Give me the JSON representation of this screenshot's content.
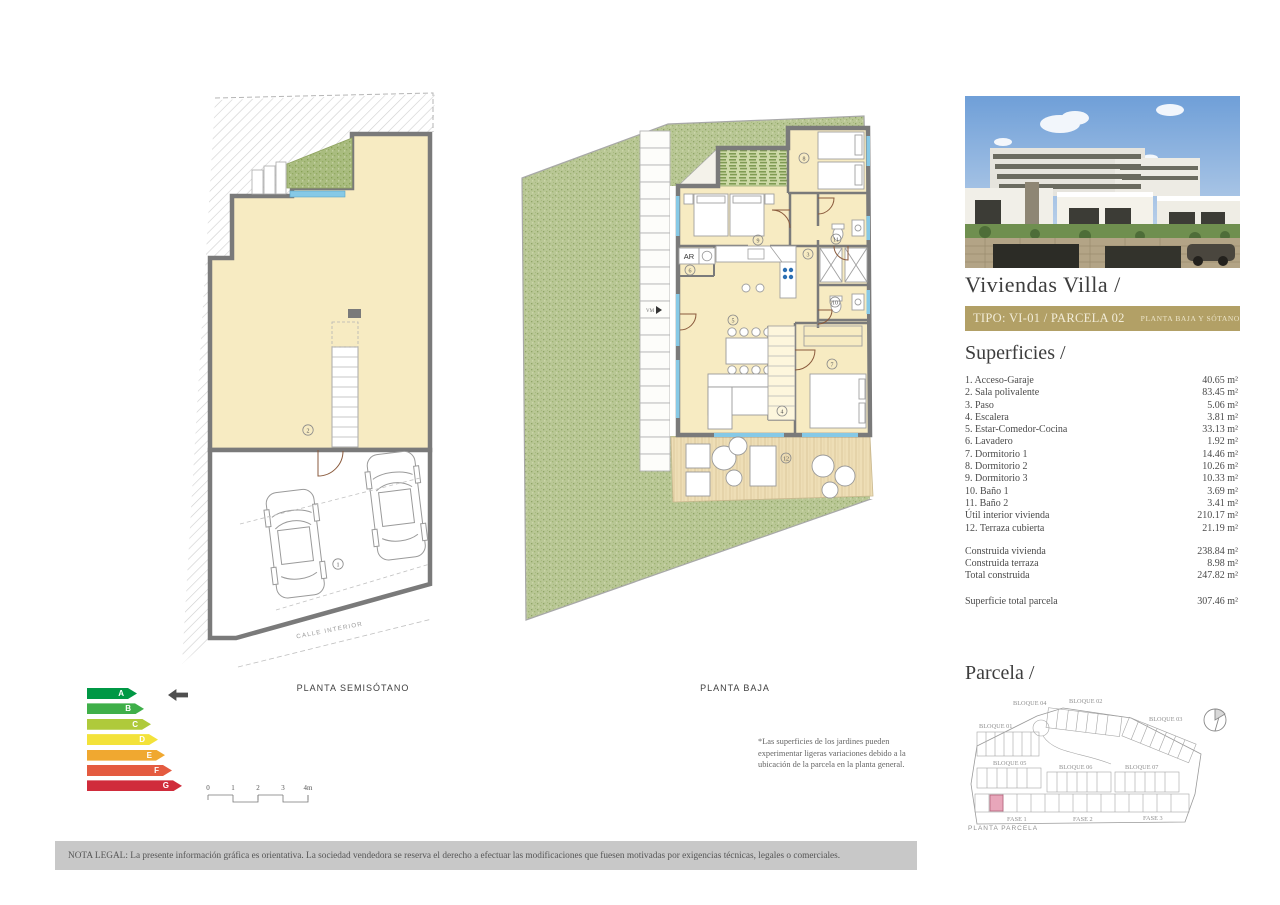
{
  "header": {
    "title": "Viviendas Villa /",
    "banner_left": "TIPO: VI-01 / PARCELA 02",
    "banner_right": "PLANTA BAJA Y SÓTANO",
    "banner_bg": "#b2a066"
  },
  "superficies": {
    "heading": "Superficies /",
    "rows": [
      {
        "label": "1. Acceso-Garaje",
        "value": "40.65 m²"
      },
      {
        "label": "2. Sala polivalente",
        "value": "83.45 m²"
      },
      {
        "label": "3. Paso",
        "value": "5.06 m²"
      },
      {
        "label": "4. Escalera",
        "value": "3.81 m²"
      },
      {
        "label": "5. Estar-Comedor-Cocina",
        "value": "33.13 m²"
      },
      {
        "label": "6. Lavadero",
        "value": "1.92 m²"
      },
      {
        "label": "7. Dormitorio 1",
        "value": "14.46 m²"
      },
      {
        "label": "8. Dormitorio 2",
        "value": "10.26 m²"
      },
      {
        "label": "9. Dormitorio 3",
        "value": "10.33 m²"
      },
      {
        "label": "10. Baño 1",
        "value": "3.69 m²"
      },
      {
        "label": "11. Baño 2",
        "value": "3.41 m²"
      },
      {
        "label": "Útil interior vivienda",
        "value": "210.17 m²"
      },
      {
        "label": "12. Terraza cubierta",
        "value": "21.19 m²"
      }
    ],
    "totals": [
      {
        "label": "Construida vivienda",
        "value": "238.84 m²"
      },
      {
        "label": "Construida terraza",
        "value": "8.98 m²"
      },
      {
        "label": "Total construida",
        "value": "247.82 m²"
      }
    ],
    "parcel_total": {
      "label": "Superficie total parcela",
      "value": "307.46 m²"
    }
  },
  "parcela": {
    "heading": "Parcela /",
    "caption": "PLANTA PARCELA",
    "bloques": [
      "BLOQUE 01",
      "BLOQUE 04",
      "BLOQUE 02",
      "BLOQUE 03",
      "BLOQUE 05",
      "BLOQUE 06",
      "BLOQUE 07"
    ],
    "fases": [
      "FASE 1",
      "FASE 2",
      "FASE 3"
    ],
    "highlight_color": "#e8a6ba"
  },
  "plans": {
    "semisotano": {
      "label": "PLANTA SEMISÓTANO",
      "street": "CALLE INTERIOR",
      "rooms": {
        "n1": "1",
        "n2": "2"
      }
    },
    "baja": {
      "label": "PLANTA BAJA",
      "ar": "AR",
      "vm": "VM",
      "rooms": {
        "n3": "3",
        "n4": "4",
        "n5": "5",
        "n6": "6",
        "n7": "7",
        "n8": "8",
        "n9": "9",
        "n10": "10",
        "n11": "11",
        "n12": "12"
      }
    }
  },
  "energy": {
    "levels": [
      {
        "letter": "A",
        "color": "#009845"
      },
      {
        "letter": "B",
        "color": "#3faf49"
      },
      {
        "letter": "C",
        "color": "#afca3b"
      },
      {
        "letter": "D",
        "color": "#f3e23a"
      },
      {
        "letter": "E",
        "color": "#f0a830"
      },
      {
        "letter": "F",
        "color": "#e45b40"
      },
      {
        "letter": "G",
        "color": "#d02c3b"
      }
    ],
    "pointer_color": "#4f4f4f"
  },
  "scale_bar": {
    "t0": "0",
    "t1": "1",
    "t2": "2",
    "t3": "3",
    "t4": "4m"
  },
  "garden_note": {
    "line1": "*Las superficies de los jardines pueden",
    "line2": "experimentar ligeras variaciones debido a la",
    "line3": "ubicación de la parcela en la planta general."
  },
  "legal": {
    "text": "NOTA LEGAL: La presente información gráfica es orientativa. La sociedad vendedora se reserva el derecho a efectuar las modificaciones que fuesen motivadas por exigencias técnicas, legales o comerciales."
  },
  "colors": {
    "floor_cream": "#f7ebc2",
    "wall_gray": "#7a7a7a",
    "garden_green": "#b9c795",
    "window_blue": "#86c9e6",
    "deck_beige": "#eedeb6"
  }
}
